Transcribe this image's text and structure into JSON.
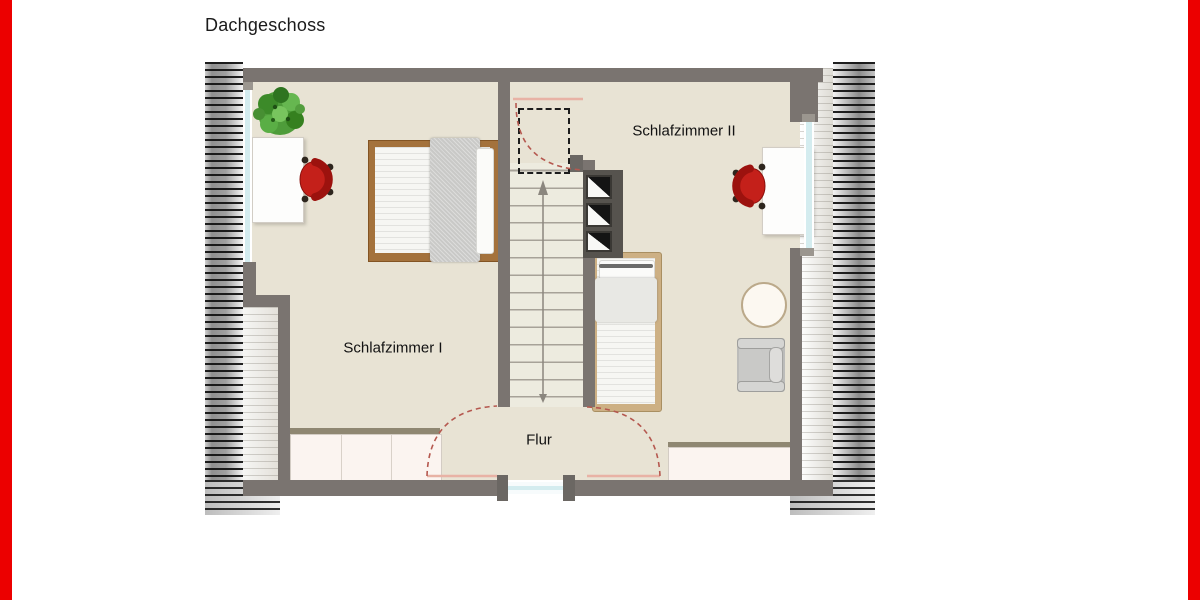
{
  "page": {
    "title": "Dachgeschoss",
    "background_color": "#ffffff",
    "accent_stripe_color": "#ec0000"
  },
  "floorplan": {
    "rooms": [
      {
        "id": "schlafzimmer-1",
        "label": "Schlafzimmer I"
      },
      {
        "id": "schlafzimmer-2",
        "label": "Schlafzimmer II"
      },
      {
        "id": "flur",
        "label": "Flur"
      }
    ],
    "features": {
      "stairs": {
        "direction": "up",
        "walk_line_arrow": "up"
      },
      "chimney_flues": 3,
      "roof_slope_hatching": [
        "left",
        "right"
      ],
      "windows": [
        "left-knee-wall",
        "right-knee-wall",
        "bottom-flur"
      ],
      "door_swings": 3,
      "dashed_headroom_outline": true
    },
    "furniture": {
      "schlafzimmer_1": [
        "potted-plant",
        "desk",
        "red-office-chair",
        "double-bed",
        "wardrobe"
      ],
      "schlafzimmer_2": [
        "desk",
        "red-office-chair",
        "single-bed",
        "round-table",
        "armchair",
        "sideboard"
      ]
    },
    "colors": {
      "wall": "#7a7470",
      "floor": "#e8e3d4",
      "window": "#d4ecef",
      "door_swing": "#b5584f",
      "door_leaf": "#e8b2a5",
      "chair_red": "#c4201a",
      "double_bed_frame": "#a4723c",
      "single_bed_frame": "#cdb084",
      "plant_green": "#4e9c3a"
    }
  }
}
